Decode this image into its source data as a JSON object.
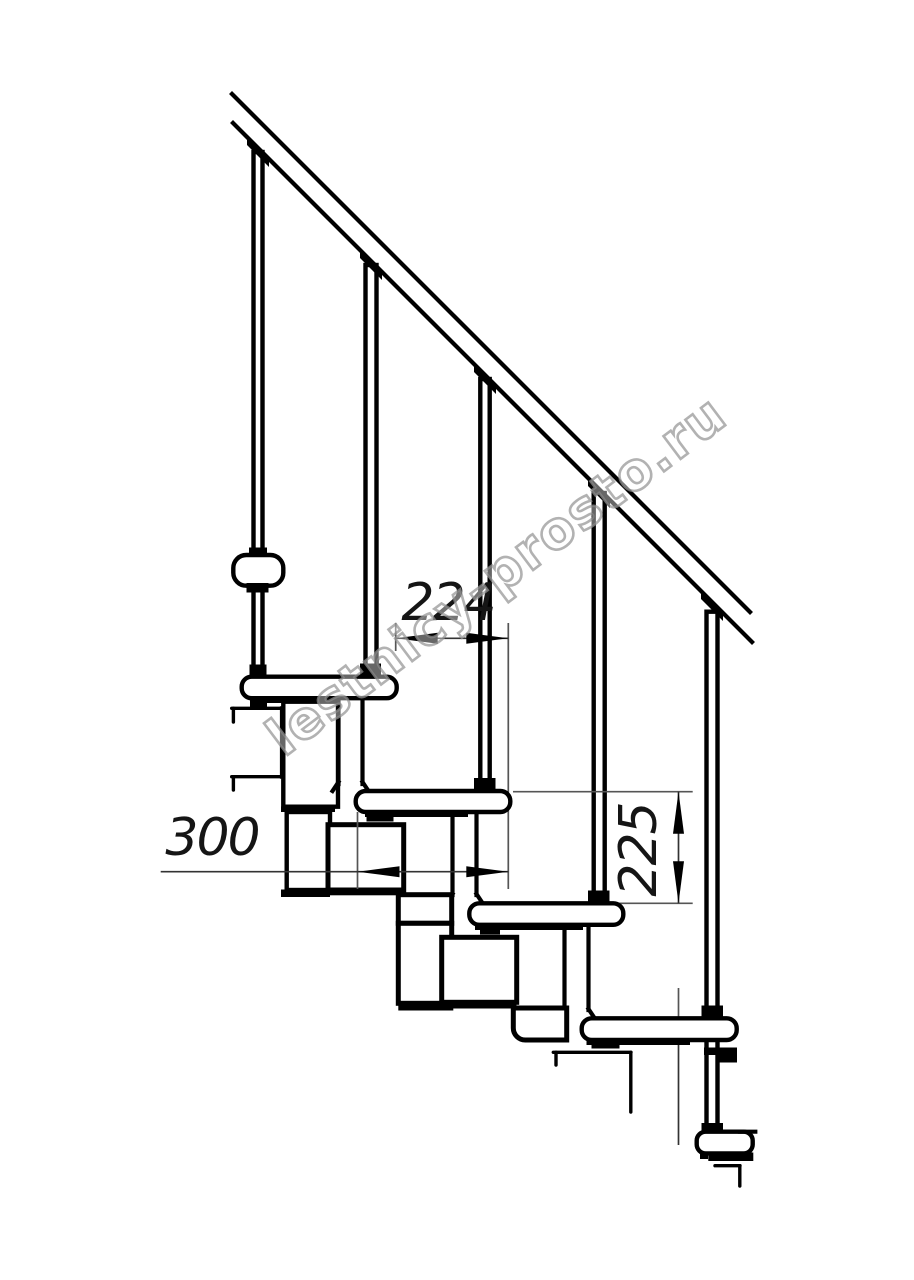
{
  "page": {
    "background": "#ffffff"
  },
  "drawing": {
    "kind": "modular-staircase-side-view-technical-drawing",
    "line_color": "#000000",
    "dim_color": "#151515",
    "watermark_color": "#949494",
    "dimensions": {
      "step_run": "224",
      "tread_depth": "300",
      "step_rise": "225"
    },
    "watermark": "lestnicy-prosto.ru"
  }
}
